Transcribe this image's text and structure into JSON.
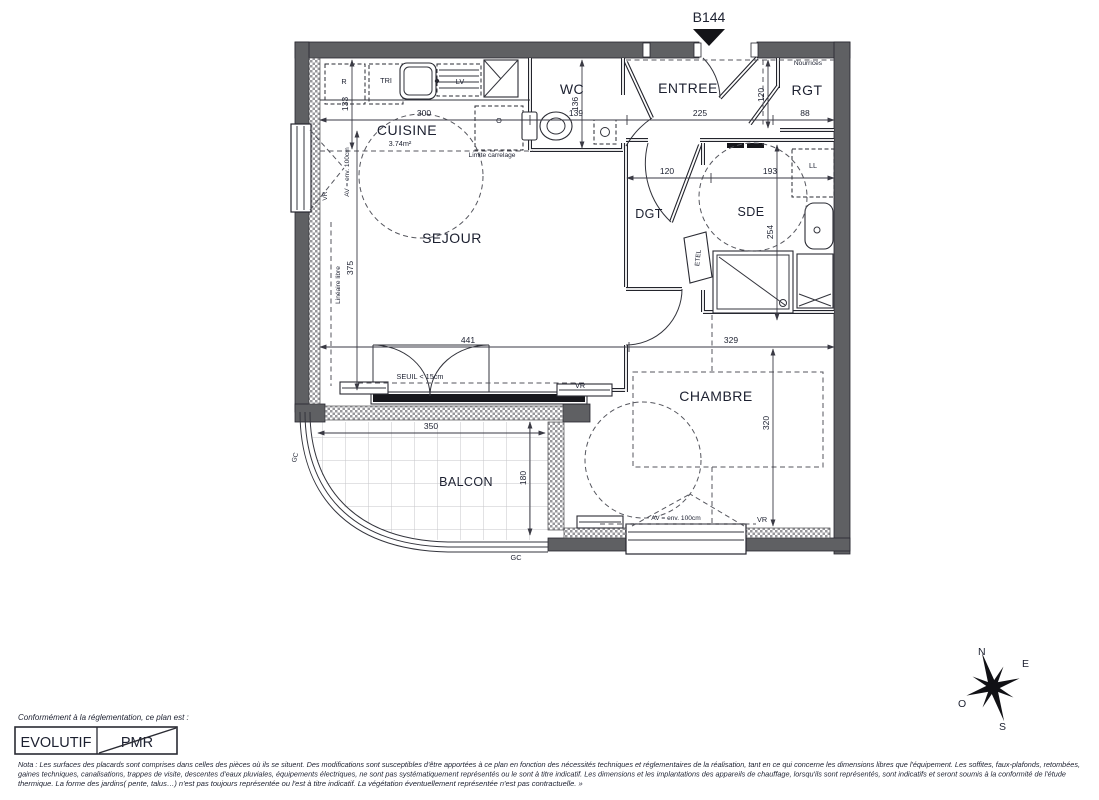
{
  "header": {
    "unit": "B144"
  },
  "rooms": {
    "cuisine": "CUISINE",
    "cuisine_area": "3.74m²",
    "wc": "WC",
    "entree": "ENTREE",
    "rgt": "RGT",
    "nourrices": "Nourrices",
    "dgt": "DGT",
    "sde": "SDE",
    "sejour": "SEJOUR",
    "chambre": "CHAMBRE",
    "balcon": "BALCON"
  },
  "dims": {
    "cuisine_width": "300",
    "wc_width": "139",
    "entree_width": "225",
    "rgt_width": "88",
    "rgt_depth": "120",
    "dgt_width": "120",
    "sde_width": "193",
    "sde_depth": "254",
    "kitchen_depth": "133",
    "wc_depth": "136",
    "sejour_depth": "375",
    "sejour_width": "441",
    "chambre_width": "329",
    "chambre_depth": "320",
    "balcon_width": "350",
    "balcon_depth": "180"
  },
  "annotations": {
    "fridge": "R",
    "sorting": "TRI",
    "dishwasher": "LV",
    "oven": "O",
    "washer": "LL",
    "etel": "ETEL",
    "vr": "VR",
    "av": "AV = env. 100cm",
    "lineaire": "Linéaire libre",
    "limite_carrelage": "Limite carrelage",
    "seuil": "SEUIL < 15cm",
    "gc": "GC"
  },
  "compass": {
    "n": "N",
    "e": "E",
    "s": "S",
    "o": "O"
  },
  "footer": {
    "conformity": "Conformément à la réglementation, ce plan est :",
    "evolutif": "EVOLUTIF",
    "pmr": "PMR",
    "nota1": "Nota : Les surfaces des placards sont comprises dans celles des pièces où ils se situent. Des modifications sont susceptibles d'être apportées à ce plan en fonction des nécessités techniques et réglementaires de la réalisation, tant en ce qui concerne les dimensions libres que l'équipement.  Les soffites, faux-plafonds, retombées,",
    "nota2": "gaines techniques, canalisations, trappes de visite, descentes d'eaux pluviales, équipements électriques, ne sont pas systématiquement représentés ou le sont à titre indicatif. Les dimensions et les implantations des appareils de chauffage, lorsqu'ils sont représentés, sont indicatifs et seront soumis à la conformité de l'étude",
    "nota3": "thermique. La forme des jardins( pente, talus…) n'est pas toujours représentée ou l'est à titre indicatif. La végétation éventuellement représentée n'est pas contractuelle. »"
  }
}
